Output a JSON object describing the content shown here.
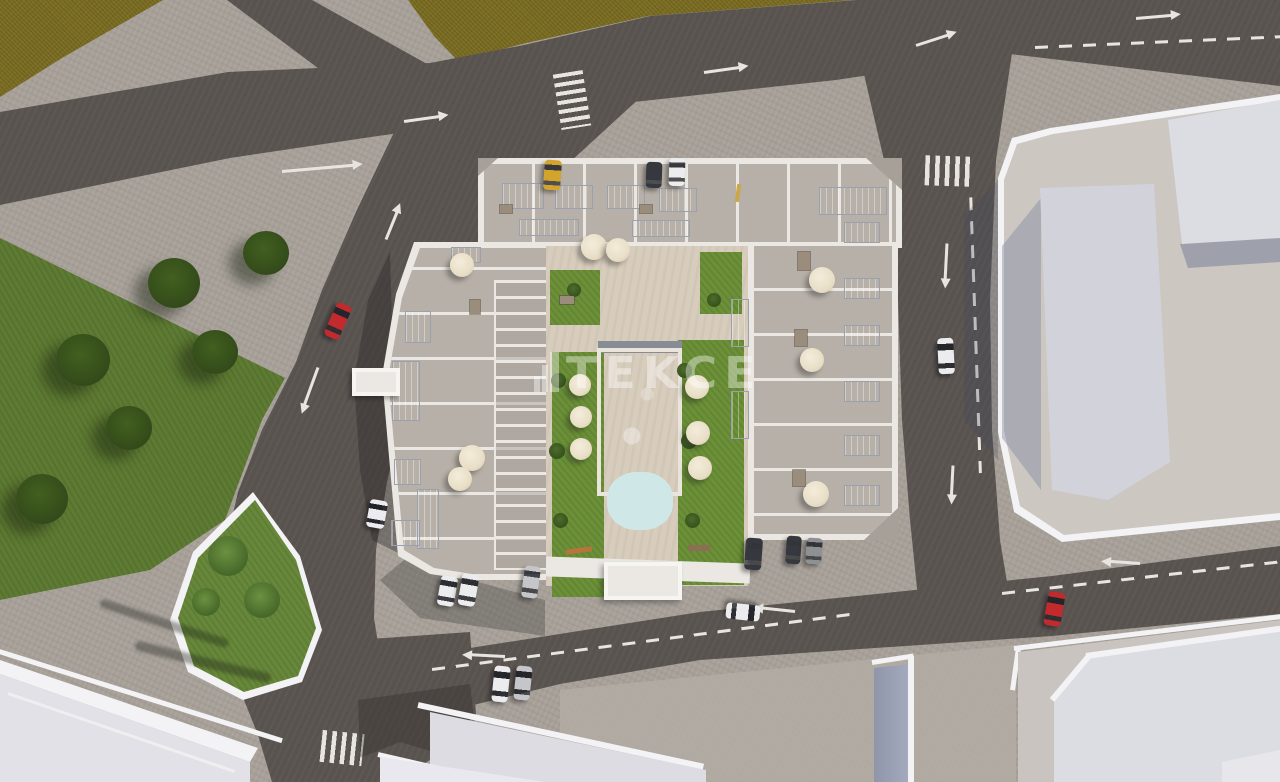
{
  "watermark": {
    "text": "TEKCE",
    "icon": "tekce-building-logo-icon"
  },
  "colors": {
    "field": "#7b6d22",
    "road": "#595350",
    "sidewalk": "#a7a099",
    "plaza_bright": "#b3aca4",
    "park_green": "#5e7b33",
    "tree_green": "#42601f",
    "island_green": "#67883a",
    "lawn_green": "#6b9038",
    "wall_white": "#ebe8e3",
    "terrace": "#b7b0a8",
    "courtyard": "#d8cdbd",
    "pool_blue": "#7fc3cd",
    "pool_light": "#cfe8e7",
    "solar_blue": "#41526f",
    "umbrella_cream": "#e9dfc8",
    "plot_plaza": "#cdc7c2",
    "tower_white": "#dcdde3",
    "tower_side": "#b6bdd2",
    "curb_white": "#f3f2f4",
    "marking_white": "#e8e5e0",
    "car_red": "#c22a2e",
    "car_yellow": "#d2a42c",
    "car_white": "#ececee",
    "car_silver": "#c4c6c9",
    "car_dark": "#35383e",
    "watermark_color": "rgba(255,255,255,0.40)"
  },
  "scene": {
    "type": "3d-aerial-architectural-render",
    "subject": "Residential apartment complex with rooftop terraces, solar panels and courtyard swimming pool",
    "surroundings": [
      "olive farmland field at top left",
      "public green park with trees on the left",
      "teardrop traffic island with palm trees",
      "asphalt roads with lane arrows, dashed lane lines and zebra crossings",
      "large white commercial buildings on the right and bottom"
    ],
    "vehicles": [
      {
        "color": "red",
        "location": "left diagonal road"
      },
      {
        "color": "yellow",
        "location": "parked at top of complex"
      },
      {
        "color": "dark",
        "location": "parked at top of complex"
      },
      {
        "color": "white",
        "location": "parked at top of complex"
      },
      {
        "color": "white",
        "location": "driving down right road"
      },
      {
        "color": "white",
        "location": "parked left of complex"
      },
      {
        "color": "white",
        "location": "parked below complex left"
      },
      {
        "color": "white",
        "location": "parked below complex left"
      },
      {
        "color": "silver",
        "location": "parked below complex left"
      },
      {
        "color": "dark",
        "location": "parked below complex right"
      },
      {
        "color": "dark",
        "location": "parked below complex right"
      },
      {
        "color": "gray",
        "location": "parked below complex right"
      },
      {
        "color": "white",
        "location": "driving left on bottom road"
      },
      {
        "color": "red",
        "location": "bottom road right"
      },
      {
        "color": "white",
        "location": "bottom intersection"
      },
      {
        "color": "silver",
        "location": "bottom intersection"
      }
    ],
    "road_markings": {
      "straight_arrows": 12,
      "zebra_crossings": 3,
      "dashed_lane_lines": 4
    },
    "amenities": {
      "swimming_pool": 1,
      "sun_umbrellas": 14,
      "solar_panel_arrays": 21
    }
  }
}
